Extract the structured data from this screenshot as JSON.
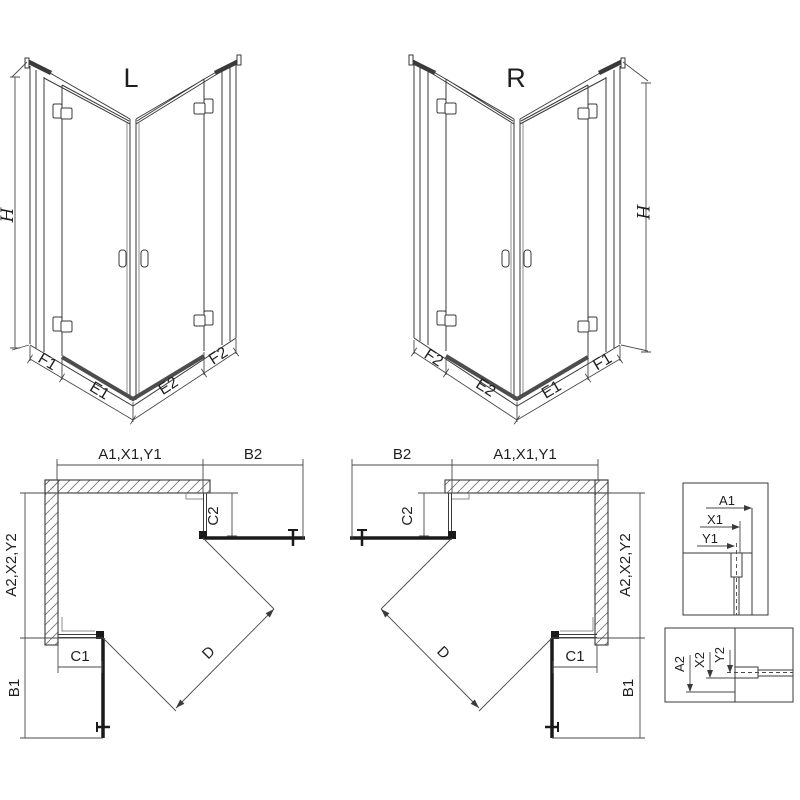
{
  "colors": {
    "background": "#ffffff",
    "line": "#3a3a3a",
    "dark": "#1a1a1a"
  },
  "iso_left": {
    "title": "L",
    "height_label": "H",
    "segment_labels": [
      "F1",
      "E1",
      "E2",
      "F2"
    ]
  },
  "iso_right": {
    "title": "R",
    "height_label": "H",
    "segment_labels": [
      "F2",
      "E2",
      "E1",
      "F1"
    ]
  },
  "plan_left": {
    "top_width_label": "A1,X1,Y1",
    "door_width_label": "B2",
    "side_depth_label": "A2,X2,Y2",
    "door_depth_label": "B1",
    "fixed_panel_side_label": "C2",
    "fixed_panel_bottom_label": "C1",
    "diagonal_label": "D"
  },
  "plan_right": {
    "top_width_label": "A1,X1,Y1",
    "door_width_label": "B2",
    "side_depth_label": "A2,X2,Y2",
    "door_depth_label": "B1",
    "fixed_panel_side_label": "C2",
    "fixed_panel_bottom_label": "C1",
    "diagonal_label": "D"
  },
  "detail_top": {
    "labels": [
      "A1",
      "X1",
      "Y1"
    ]
  },
  "detail_bottom": {
    "labels": [
      "A2",
      "X2",
      "Y2"
    ]
  }
}
